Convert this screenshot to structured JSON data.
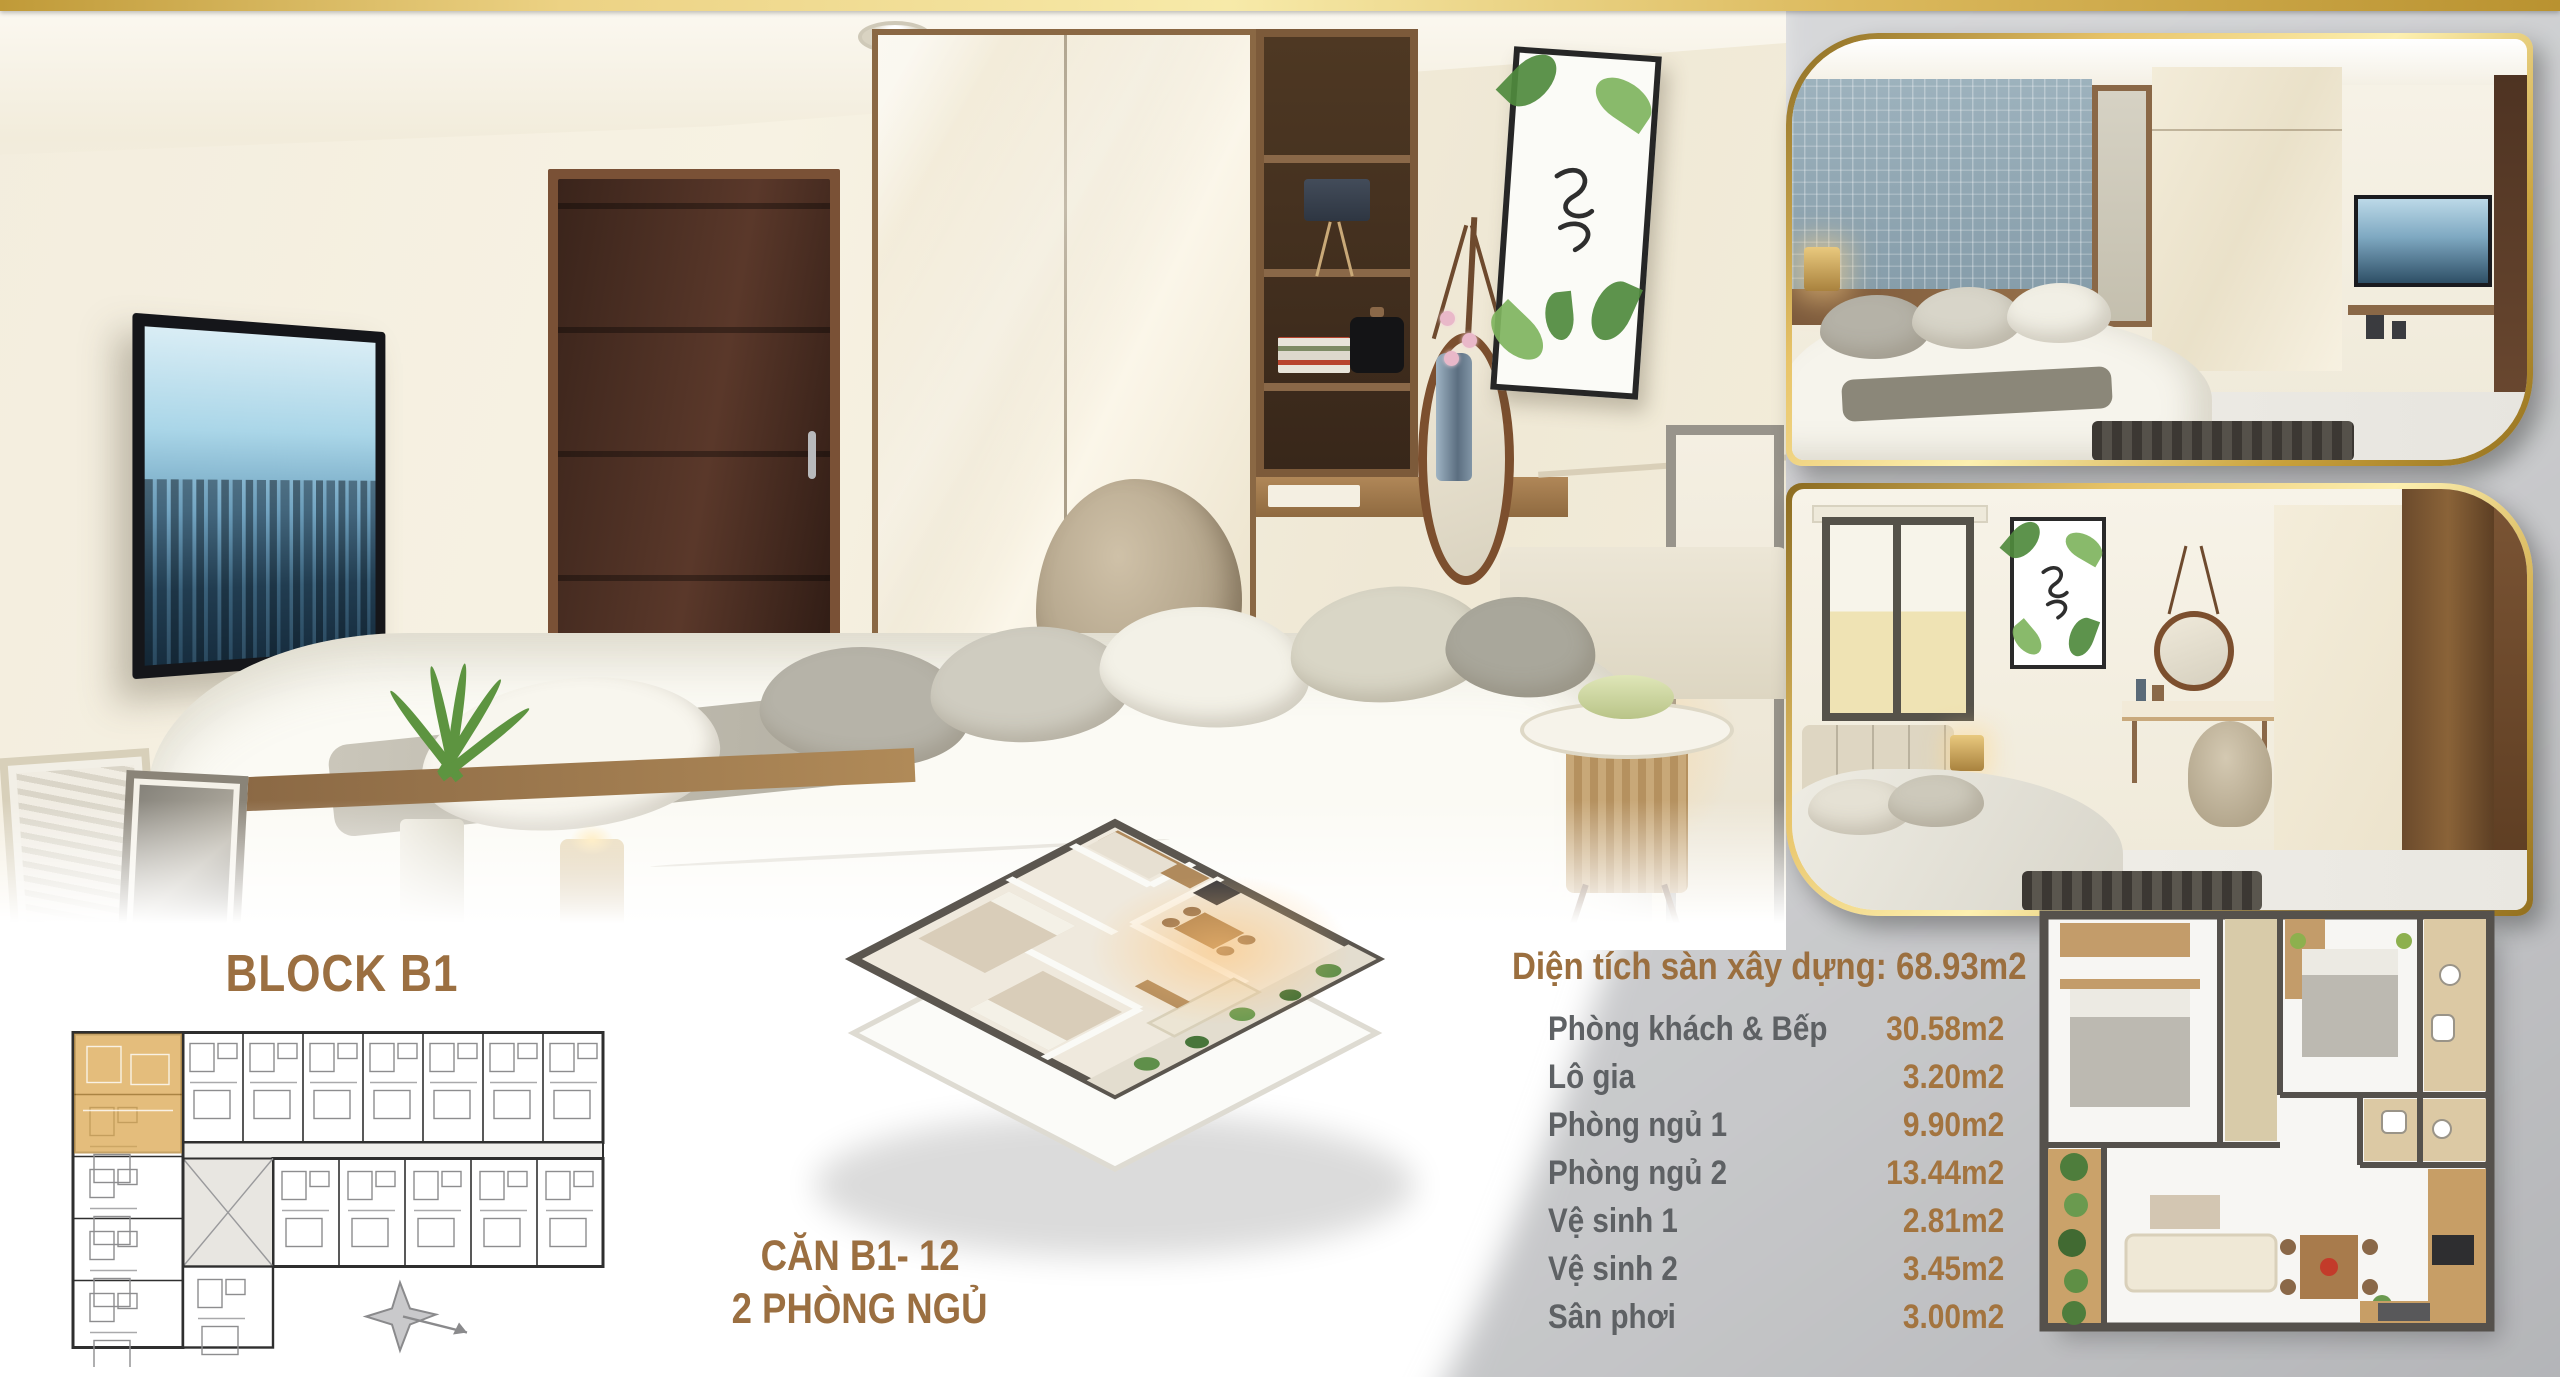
{
  "block": {
    "title": "BLOCK B1"
  },
  "unit_caption": {
    "line1": "CĂN B1- 12",
    "line2": "2 PHÒNG NGỦ"
  },
  "specs": {
    "title": "Diện tích sàn xây dựng: 68.93m2",
    "rows": [
      {
        "label": "Phòng khách & Bếp",
        "value": "30.58m2"
      },
      {
        "label": "Lô gia",
        "value": "3.20m2"
      },
      {
        "label": "Phòng ngủ 1",
        "value": "9.90m2"
      },
      {
        "label": "Phòng ngủ 2",
        "value": "13.44m2"
      },
      {
        "label": "Vệ sinh 1",
        "value": "2.81m2"
      },
      {
        "label": "Vệ sinh 2",
        "value": "3.45m2"
      },
      {
        "label": "Sân phơi",
        "value": "3.00m2"
      }
    ]
  },
  "colors": {
    "accent_gold_text": "#9b6f3f",
    "label_gray": "#5e6164",
    "gold_bar": "#e3c268",
    "panel_gray": "#c7c8ca",
    "highlight_unit": "#daa54b"
  },
  "icons": {
    "compass_rose": "compass-rose-icon"
  }
}
